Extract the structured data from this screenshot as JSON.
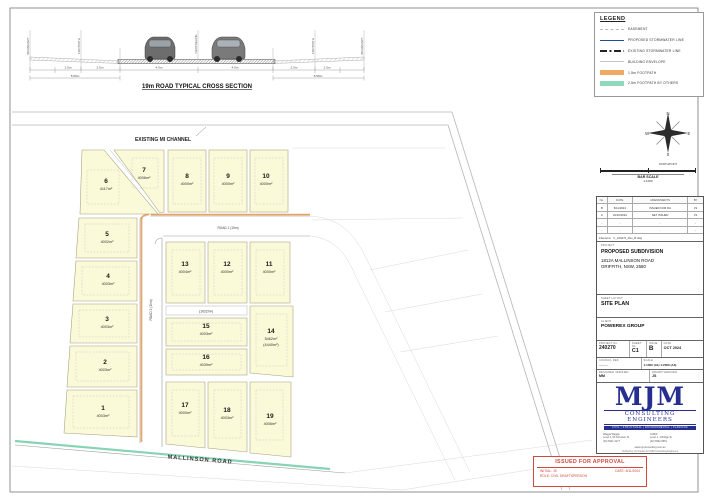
{
  "cross_section": {
    "title": "19m ROAD TYPICAL CROSS SECTION",
    "labels": [
      "BOUNDARY",
      "FOOTPATH",
      "CENTRELINE",
      "FOOTPATH",
      "BOUNDARY"
    ],
    "dims": [
      "1.5m",
      "2.5m",
      "4.0m",
      "4.0m",
      "2.5m",
      "1.5m"
    ],
    "totals": [
      "5.50m",
      "5.50m"
    ]
  },
  "legend": {
    "title": "LEGEND",
    "items": [
      {
        "label": "EASEMENT"
      },
      {
        "label": "PROPOSED STORMWATER LINE"
      },
      {
        "label": "EXISTING STORMWATER LINE"
      },
      {
        "label": "BUILDING ENVELOPE"
      },
      {
        "label": "1.5m FOOTPATH"
      },
      {
        "label": "2.5m FOOTPATH BY OTHERS"
      }
    ]
  },
  "compass": {
    "n": "N",
    "e": "E",
    "s": "S",
    "w": "W",
    "caption": "NORTHPOINT"
  },
  "bar_scale": {
    "caption": "BAR SCALE",
    "ratio": "1:1000"
  },
  "site_plan": {
    "channel_label": "EXISTING MI CHANNEL",
    "mallinson_label": "MALLINSON ROAD",
    "road1_label": "ROAD 1 (19m)",
    "road2_label": "ROAD 2 (19m)",
    "reserve_label": "(1022m²)",
    "lots": [
      {
        "num": "1",
        "area": "4003m²"
      },
      {
        "num": "2",
        "area": "4003m²"
      },
      {
        "num": "3",
        "area": "4003m²"
      },
      {
        "num": "4",
        "area": "4003m²"
      },
      {
        "num": "5",
        "area": "4002m²"
      },
      {
        "num": "6",
        "area": "4117m²"
      },
      {
        "num": "7",
        "area": "4006m²"
      },
      {
        "num": "8",
        "area": "4000m²"
      },
      {
        "num": "9",
        "area": "4000m²"
      },
      {
        "num": "10",
        "area": "4000m²"
      },
      {
        "num": "11",
        "area": "4000m²"
      },
      {
        "num": "12",
        "area": "4000m²"
      },
      {
        "num": "13",
        "area": "4004m²"
      },
      {
        "num": "14",
        "area": "5462m²",
        "area2": "(4440m²)"
      },
      {
        "num": "15",
        "area": "4003m²"
      },
      {
        "num": "16",
        "area": "4039m²"
      },
      {
        "num": "17",
        "area": "4000m²"
      },
      {
        "num": "18",
        "area": "4003m²"
      },
      {
        "num": "19",
        "area": "4006m²"
      }
    ]
  },
  "revision_table": {
    "headers": [
      "No.",
      "DATE",
      "AMENDMENTS",
      "BY"
    ],
    "rows": [
      [
        "B",
        "6/11/2024",
        "ISSUED FOR DA",
        "JS"
      ],
      [
        "A",
        "01/10/2024",
        "SET ISSUED",
        "JS"
      ],
      [
        "-",
        "-",
        "-",
        "-"
      ],
      [
        "-",
        "-",
        "-",
        "-"
      ]
    ],
    "filename_label": "Filename:",
    "filename": "C_240270_Rev_B.dwg"
  },
  "title_block": {
    "project_label": "PROJECT",
    "project": "PROPOSED SUBDIVISION",
    "address1": "1812A MALLINSON ROAD",
    "address2": "GRIFFITH, NSW, 2680",
    "sheet_label": "SHEET LAYOUT",
    "sheet": "SITE PLAN",
    "client_label": "CLIENT",
    "client": "POWEREX GROUP",
    "project_no_label": "PROJECT No.",
    "project_no": "240270",
    "sheet_no_label": "SHEET No.",
    "sheet_no": "C1",
    "issue_label": "ISSUE",
    "issue": "B",
    "date_label": "DATE",
    "date": "OCT 2024",
    "council_label": "COUNCIL REF.",
    "council": "---------",
    "scale_label": "SCALE",
    "scale": "1:1000 (A1) 1:2000 (A3)",
    "designed_label": "DESIGNED   VERIFIED",
    "designed": "MM",
    "drawn_label": "DRAWN   VERIFIED",
    "drawn": "JS"
  },
  "firm": {
    "logo": "MJM",
    "name": "CONSULTING ENGINEERS",
    "disciplines": "CIVIL | STRUCTURAL | ENVIRONMENTAL | PLANNING",
    "office1_name": "Wagga Wagga:",
    "office1_addr": "Level 1, 53 Johnston St",
    "office1_phone": "(02) 6921 4177",
    "office2_name": "Griffith:",
    "office2_addr": "Level 1, 1 Bridge St",
    "office2_phone": "(02) 6962 9551",
    "web": "www.mjmconsulting.com.au",
    "footer": "Verified by Col Jordan for MJM Consulting Engineers"
  },
  "approval": {
    "title": "ISSUED FOR APPROVAL",
    "initial": "INITIAL: JS",
    "date": "DATE: 6/11/2024",
    "role": "ROLE: CIVIL DRAFTSPERSON"
  }
}
